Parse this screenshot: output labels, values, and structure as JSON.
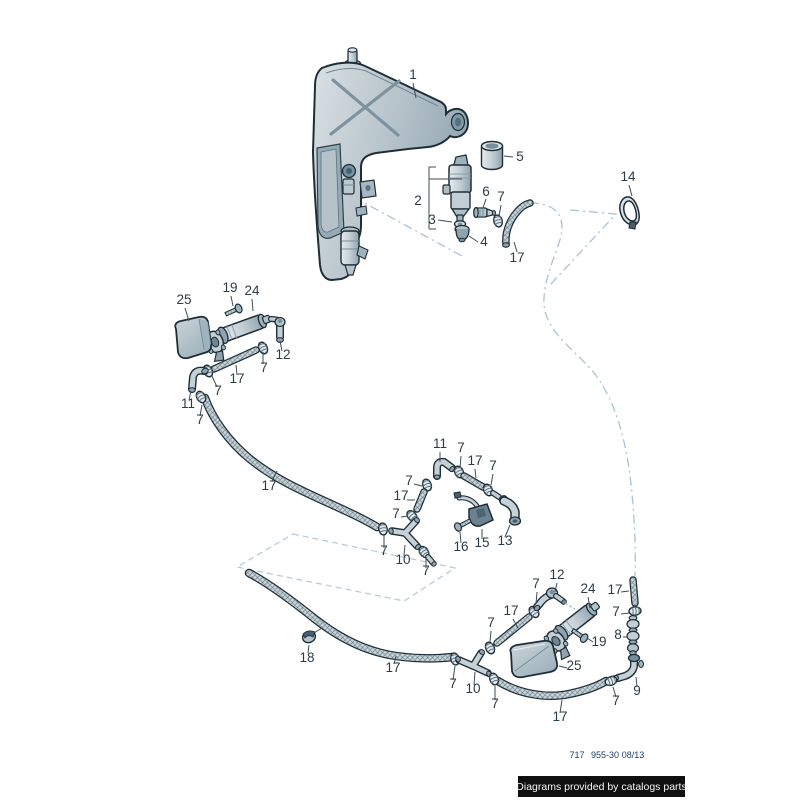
{
  "labels": {
    "n1": "1",
    "n2": "2",
    "n3": "3",
    "n4": "4",
    "n5": "5",
    "n6": "6",
    "n7": "7",
    "n8": "8",
    "n9": "9",
    "n10": "10",
    "n11": "11",
    "n12": "12",
    "n13": "13",
    "n14": "14",
    "n15": "15",
    "n16": "16",
    "n17": "17",
    "n18": "18",
    "n19": "19",
    "n24": "24",
    "n25": "25"
  },
  "footer": {
    "catalog_number": "717",
    "part_group": "955-30",
    "date": "08/13"
  },
  "watermark": {
    "text": "Diagrams provided by catalogs parts"
  },
  "colors": {
    "outline": "#1e2e38",
    "part_fill": "#c6d1d7",
    "part_shade": "#8fa3ae",
    "guide_line": "#a9c3d6",
    "label_text": "#2c3c46",
    "watermark_bg": "#101010",
    "watermark_text": "#f5f5f5",
    "footer_text": "#1c3f63"
  }
}
